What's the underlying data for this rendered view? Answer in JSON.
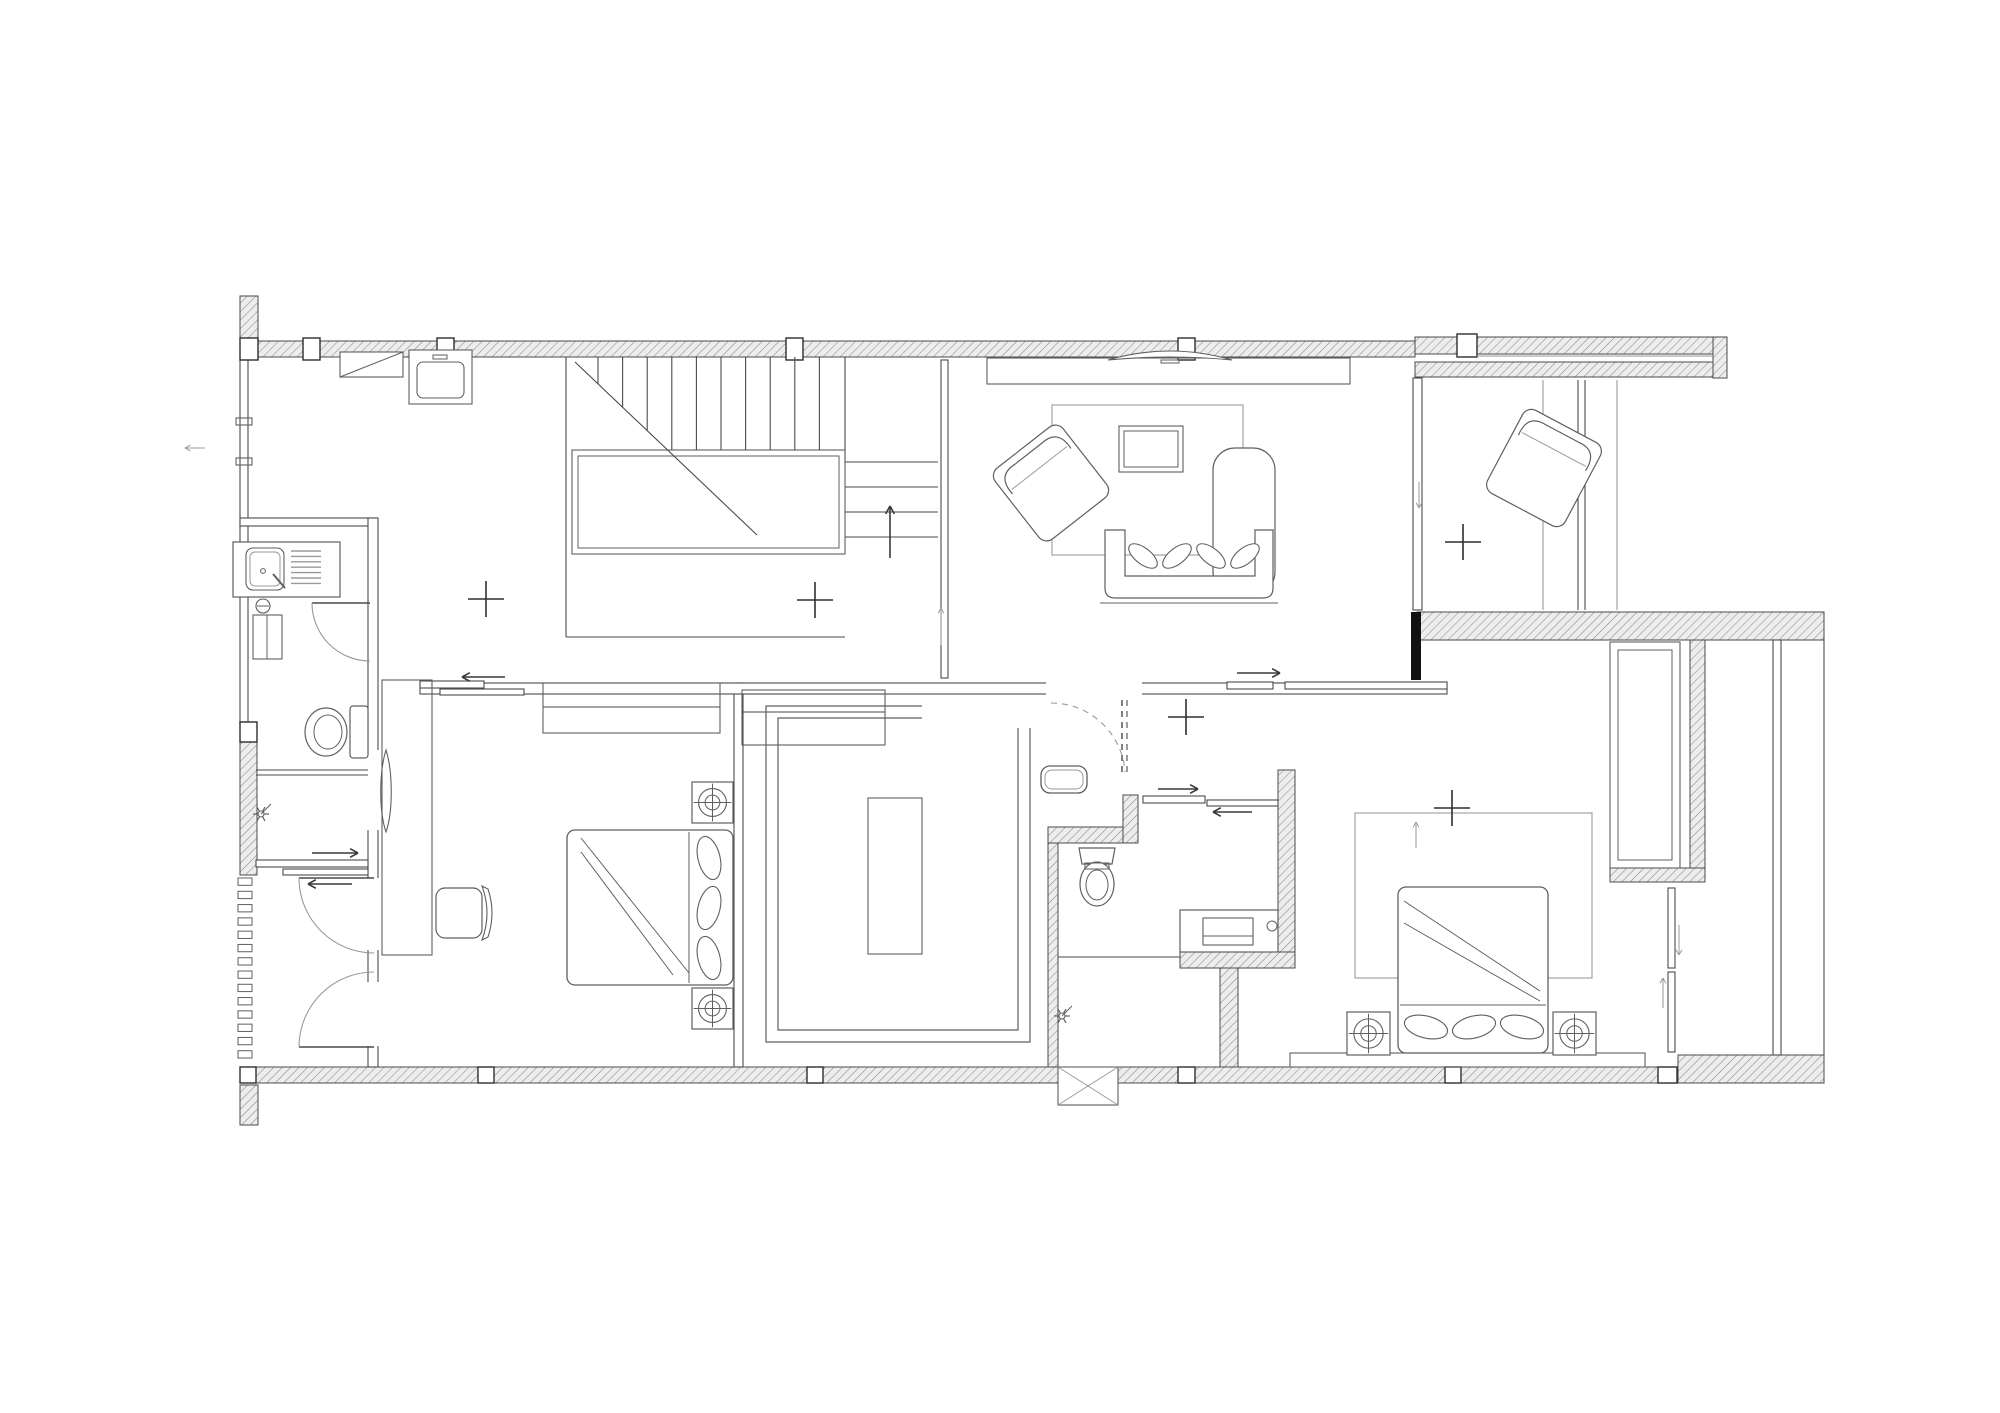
{
  "meta": {
    "canvas": {
      "w": 2000,
      "h": 1413
    }
  },
  "colors": {
    "bg": "#ffffff",
    "wall_stroke": "#4a4a4a",
    "furniture_stroke": "#5f5f5f",
    "light_stroke": "#9a9a9a",
    "hatch_fill": "#ededed",
    "hatch_line": "#8c8c8c",
    "solid_wall": "#111111",
    "column_fill": "#ffffff"
  },
  "plan": {
    "hatched_walls": [
      {
        "n": "top-wall-left",
        "x": 240,
        "y": 341,
        "w": 1175,
        "h": 16
      },
      {
        "n": "top-wall-right-outer",
        "x": 1415,
        "y": 337,
        "w": 312,
        "h": 17
      },
      {
        "n": "top-wall-right-inner",
        "x": 1415,
        "y": 362,
        "w": 298,
        "h": 15
      },
      {
        "n": "top-right-end-cap",
        "x": 1713,
        "y": 337,
        "w": 14,
        "h": 41
      },
      {
        "n": "left-wall-stub-top",
        "x": 240,
        "y": 296,
        "w": 18,
        "h": 45
      },
      {
        "n": "left-wall-mid",
        "x": 240,
        "y": 742,
        "w": 17,
        "h": 133
      },
      {
        "n": "left-wall-stub-bottom",
        "x": 240,
        "y": 1085,
        "w": 18,
        "h": 40
      },
      {
        "n": "bottom-wall-main",
        "x": 256,
        "y": 1067,
        "w": 1404,
        "h": 16
      },
      {
        "n": "bottom-wall-right",
        "x": 1678,
        "y": 1055,
        "w": 146,
        "h": 28
      },
      {
        "n": "suite-top-wall",
        "x": 1417,
        "y": 612,
        "w": 407,
        "h": 28
      },
      {
        "n": "nook-right-wall",
        "x": 1690,
        "y": 640,
        "w": 15,
        "h": 235
      },
      {
        "n": "nook-bottom-cap",
        "x": 1610,
        "y": 868,
        "w": 95,
        "h": 14
      },
      {
        "n": "bath2-right-wall",
        "x": 1278,
        "y": 770,
        "w": 17,
        "h": 198
      },
      {
        "n": "bath2-under-vanity-wall",
        "x": 1180,
        "y": 952,
        "w": 115,
        "h": 16
      },
      {
        "n": "bath2-left-wall",
        "x": 1048,
        "y": 843,
        "w": 10,
        "h": 224
      },
      {
        "n": "bath2-under-counter-wall",
        "x": 1048,
        "y": 827,
        "w": 90,
        "h": 16
      },
      {
        "n": "bath2-door-jamb",
        "x": 1123,
        "y": 795,
        "w": 15,
        "h": 48
      },
      {
        "n": "corridor-wall-bar",
        "x": 1220,
        "y": 968,
        "w": 18,
        "h": 99
      },
      {
        "n": "bed1-wall-seg-a",
        "x": 368,
        "y": 930,
        "w": 10,
        "h": 48
      },
      {
        "n": "bed1-wall-seg-b",
        "x": 368,
        "y": 1048,
        "w": 10,
        "h": 19
      }
    ],
    "solid_walls": [
      {
        "n": "suite-black-wall",
        "x": 1411,
        "y": 612,
        "w": 10,
        "h": 68
      }
    ],
    "columns": [
      {
        "n": "column",
        "x": 240,
        "y": 338,
        "w": 18,
        "h": 22
      },
      {
        "n": "column",
        "x": 303,
        "y": 338,
        "w": 17,
        "h": 22
      },
      {
        "n": "column",
        "x": 437,
        "y": 338,
        "w": 17,
        "h": 22
      },
      {
        "n": "column",
        "x": 786,
        "y": 338,
        "w": 17,
        "h": 22
      },
      {
        "n": "column",
        "x": 1178,
        "y": 338,
        "w": 17,
        "h": 22
      },
      {
        "n": "column",
        "x": 1457,
        "y": 334,
        "w": 20,
        "h": 23
      },
      {
        "n": "column",
        "x": 240,
        "y": 722,
        "w": 17,
        "h": 20
      },
      {
        "n": "column",
        "x": 240,
        "y": 1067,
        "w": 16,
        "h": 16
      },
      {
        "n": "column",
        "x": 478,
        "y": 1067,
        "w": 16,
        "h": 16
      },
      {
        "n": "column",
        "x": 807,
        "y": 1067,
        "w": 16,
        "h": 16
      },
      {
        "n": "column",
        "x": 1178,
        "y": 1067,
        "w": 17,
        "h": 16
      },
      {
        "n": "column",
        "x": 1445,
        "y": 1067,
        "w": 16,
        "h": 16
      },
      {
        "n": "column",
        "x": 1658,
        "y": 1067,
        "w": 19,
        "h": 16
      }
    ],
    "gaps": [
      {
        "n": "door-gap",
        "x": 366,
        "y": 750,
        "w": 14,
        "h": 80
      },
      {
        "n": "door-gap",
        "x": 366,
        "y": 878,
        "w": 14,
        "h": 72
      },
      {
        "n": "door-gap",
        "x": 366,
        "y": 982,
        "w": 14,
        "h": 64
      },
      {
        "n": "door-gap",
        "x": 1046,
        "y": 681,
        "w": 96,
        "h": 15
      }
    ],
    "thin_walls": [
      {
        "n": "left-window-wall",
        "x": 240,
        "y": 357,
        "w": 8,
        "h": 365
      },
      {
        "n": "bath1-top-wall",
        "x": 240,
        "y": 518,
        "w": 136,
        "h": 8
      },
      {
        "n": "bath1-right-wall",
        "x": 368,
        "y": 518,
        "w": 10,
        "h": 549
      },
      {
        "n": "hall-divider-wall",
        "x": 941,
        "y": 360,
        "w": 7,
        "h": 318
      },
      {
        "n": "bed1-right-wall",
        "x": 734,
        "y": 683,
        "w": 9,
        "h": 384
      },
      {
        "n": "corridor-wall",
        "x": 420,
        "y": 683,
        "w": 1027,
        "h": 11
      },
      {
        "n": "living-right-window",
        "x": 1413,
        "y": 378,
        "w": 9,
        "h": 232
      },
      {
        "n": "slide-track",
        "x": 420,
        "y": 681,
        "w": 64,
        "h": 7
      },
      {
        "n": "slide-track",
        "x": 440,
        "y": 689,
        "w": 84,
        "h": 6
      },
      {
        "n": "slide-track",
        "x": 256,
        "y": 860,
        "w": 112,
        "h": 7
      },
      {
        "n": "slide-track",
        "x": 283,
        "y": 869,
        "w": 85,
        "h": 6
      },
      {
        "n": "slide-track",
        "x": 1227,
        "y": 682,
        "w": 46,
        "h": 7
      },
      {
        "n": "slide-track",
        "x": 1285,
        "y": 682,
        "w": 162,
        "h": 7
      },
      {
        "n": "slide-track",
        "x": 1143,
        "y": 796,
        "w": 62,
        "h": 7
      },
      {
        "n": "slide-track",
        "x": 1207,
        "y": 800,
        "w": 71,
        "h": 6
      },
      {
        "n": "slide-track",
        "x": 1668,
        "y": 888,
        "w": 7,
        "h": 80
      },
      {
        "n": "slide-track",
        "x": 1668,
        "y": 972,
        "w": 7,
        "h": 80
      },
      {
        "n": "balcony-window",
        "x": 1773,
        "y": 640,
        "w": 8,
        "h": 415
      }
    ],
    "lines": [
      {
        "n": "stair-edge",
        "x1": 566,
        "y1": 357,
        "x2": 566,
        "y2": 637
      },
      {
        "n": "stair-edge",
        "x1": 566,
        "y1": 637,
        "x2": 845,
        "y2": 637
      },
      {
        "n": "stair-edge",
        "x1": 845,
        "y1": 357,
        "x2": 845,
        "y2": 462
      },
      {
        "n": "stair-step",
        "x1": 845,
        "y1": 462,
        "x2": 938,
        "y2": 462
      },
      {
        "n": "stair-step",
        "x1": 845,
        "y1": 487,
        "x2": 938,
        "y2": 487
      },
      {
        "n": "stair-step",
        "x1": 845,
        "y1": 512,
        "x2": 938,
        "y2": 512
      },
      {
        "n": "stair-step",
        "x1": 845,
        "y1": 537,
        "x2": 938,
        "y2": 537
      },
      {
        "n": "parapet-glazing",
        "x1": 1477,
        "y1": 356,
        "x2": 1713,
        "y2": 356,
        "light": true
      },
      {
        "n": "glass-panel",
        "x1": 1543,
        "y1": 380,
        "x2": 1543,
        "y2": 610,
        "light": true
      },
      {
        "n": "glass-panel",
        "x1": 1578,
        "y1": 380,
        "x2": 1578,
        "y2": 610
      },
      {
        "n": "glass-panel",
        "x1": 1585,
        "y1": 380,
        "x2": 1585,
        "y2": 610
      },
      {
        "n": "glass-panel",
        "x1": 1617,
        "y1": 380,
        "x2": 1617,
        "y2": 610,
        "light": true
      },
      {
        "n": "balcony-edge",
        "x1": 1824,
        "y1": 637,
        "x2": 1824,
        "y2": 1055
      },
      {
        "n": "shower-divider",
        "x1": 256,
        "y1": 770,
        "x2": 368,
        "y2": 770
      },
      {
        "n": "shower-divider",
        "x1": 256,
        "y1": 775,
        "x2": 368,
        "y2": 775
      },
      {
        "n": "bath2-shower-divider",
        "x1": 1058,
        "y1": 957,
        "x2": 1180,
        "y2": 957
      },
      {
        "n": "band-shelf-line",
        "x1": 543,
        "y1": 707,
        "x2": 720,
        "y2": 707
      },
      {
        "n": "band-shelf-line",
        "x1": 742,
        "y1": 712,
        "x2": 885,
        "y2": 712
      }
    ],
    "rects": [
      {
        "n": "stair-landing",
        "x": 572,
        "y": 450,
        "w": 273,
        "h": 104,
        "inset": 6
      },
      {
        "n": "closet-band-left",
        "x": 543,
        "y": 683,
        "w": 177,
        "h": 50
      },
      {
        "n": "closet-band-right",
        "x": 742,
        "y": 690,
        "w": 143,
        "h": 55
      },
      {
        "n": "closet-island",
        "x": 868,
        "y": 798,
        "w": 54,
        "h": 156
      },
      {
        "n": "living-rug",
        "x": 1052,
        "y": 405,
        "w": 191,
        "h": 150,
        "light": true
      },
      {
        "n": "coffee-table",
        "x": 1119,
        "y": 426,
        "w": 64,
        "h": 46,
        "inset": 5
      },
      {
        "n": "tv-console",
        "x": 987,
        "y": 358,
        "w": 363,
        "h": 26
      },
      {
        "n": "desk",
        "x": 382,
        "y": 680,
        "w": 50,
        "h": 275
      },
      {
        "n": "wardrobe-nook",
        "x": 1610,
        "y": 642,
        "w": 70,
        "h": 226,
        "inset": 8
      },
      {
        "n": "bedroom2-rug",
        "x": 1355,
        "y": 813,
        "w": 237,
        "h": 165,
        "light": true
      },
      {
        "n": "bed-bench",
        "x": 1290,
        "y": 1053,
        "w": 355,
        "h": 14
      },
      {
        "n": "window-sill",
        "x": 236,
        "y": 418,
        "w": 16,
        "h": 7
      },
      {
        "n": "window-sill",
        "x": 236,
        "y": 458,
        "w": 16,
        "h": 7
      }
    ],
    "stripe_groups": [
      {
        "n": "louver-vent",
        "x": 238,
        "y": 878,
        "w": 14,
        "h": 186,
        "count": 14,
        "dir": "h"
      }
    ],
    "stairs": {
      "n": "stair-treads",
      "x0": 598,
      "count": 10,
      "dx": 24.6,
      "y1": 357,
      "y2": 450,
      "diag": [
        575,
        362,
        757,
        535
      ]
    },
    "closet_paths": [
      {
        "n": "walkin-closet-outline",
        "d": "M 922,706 L 766,706 L 766,1042 L 1030,1042 L 1030,728"
      },
      {
        "n": "walkin-closet-outline",
        "d": "M 922,718 L 778,718 L 778,1030 L 1018,1030 L 1018,728"
      }
    ],
    "door_swings": [
      {
        "n": "bath1-door-swing",
        "leaf": [
          312,
          603,
          370,
          603
        ],
        "arc": "M 312,603 A 58 58 0 0 0 370,661"
      },
      {
        "n": "vestibule-door-swing",
        "leaf": [
          299,
          878,
          374,
          878
        ],
        "arc": "M 299,878 A 75 75 0 0 0 374,953"
      },
      {
        "n": "vestibule-door-swing-2",
        "leaf": [
          299,
          1047,
          374,
          1047
        ],
        "arc": "M 299,1047 A 75 75 0 0 1 374,972"
      },
      {
        "n": "bath2-door-swing",
        "leaf": [
          1122,
          700,
          1122,
          772
        ],
        "leaf2": [
          1127,
          700,
          1127,
          772
        ],
        "arc": "M 1051,703 A 74 74 0 0 1 1125,772",
        "dashed": true
      }
    ],
    "mirror_lens": {
      "n": "mirror",
      "d": "M 386,750 C 379,772 379,812 386,832 C 393,812 393,772 386,750 Z"
    },
    "fixtures": [
      {
        "t": "sinkcounter",
        "n": "kitchen-sink-counter",
        "x": 233,
        "y": 542
      },
      {
        "t": "heater",
        "n": "water-heater",
        "x": 253,
        "y": 598
      },
      {
        "t": "toilet",
        "n": "toilet",
        "x": 326,
        "y": 732,
        "dir": "w"
      },
      {
        "t": "showerhead",
        "n": "shower-head",
        "x": 261,
        "y": 814
      },
      {
        "t": "toilet",
        "n": "toilet",
        "x": 1097,
        "y": 884,
        "dir": "s"
      },
      {
        "t": "basin",
        "n": "countertop-basin",
        "x": 1041,
        "y": 766
      },
      {
        "t": "vanity",
        "n": "vanity-cabinet",
        "x": 1180,
        "y": 910
      },
      {
        "t": "showerhead",
        "n": "shower-head",
        "x": 1062,
        "y": 1016
      },
      {
        "t": "tv",
        "n": "television",
        "x": 1170,
        "y": 352
      },
      {
        "t": "sofa",
        "n": "l-shaped-sofa",
        "x": 1105,
        "y": 448
      },
      {
        "t": "armchair",
        "n": "armchair",
        "x": 1051,
        "y": 483,
        "rot": -38,
        "w": 86,
        "h": 90
      },
      {
        "t": "armchair",
        "n": "armchair",
        "x": 1544,
        "y": 468,
        "rot": 28,
        "w": 88,
        "h": 94
      },
      {
        "t": "chair",
        "n": "desk-chair",
        "x": 462,
        "y": 913
      },
      {
        "t": "bed",
        "n": "bed-double",
        "x": 567,
        "y": 830,
        "w": 166,
        "h": 155,
        "head": "right"
      },
      {
        "t": "bed",
        "n": "bed-double",
        "x": 1398,
        "y": 887,
        "w": 150,
        "h": 166,
        "head": "bottom"
      },
      {
        "t": "spot",
        "n": "ceiling-spotlight",
        "x": 692,
        "y": 782,
        "s": 41
      },
      {
        "t": "spot",
        "n": "ceiling-spotlight",
        "x": 692,
        "y": 988,
        "s": 41
      },
      {
        "t": "spot",
        "n": "ceiling-spotlight",
        "x": 1347,
        "y": 1012,
        "s": 43
      },
      {
        "t": "spot",
        "n": "ceiling-spotlight",
        "x": 1553,
        "y": 1012,
        "s": 43
      },
      {
        "t": "acx",
        "n": "ac-outdoor-unit",
        "x": 1058,
        "y": 1067,
        "w": 60,
        "h": 38
      },
      {
        "t": "appliance",
        "n": "cooktop-appliance",
        "x": 409,
        "y": 350
      },
      {
        "t": "diagrect",
        "n": "vent-cabinet",
        "x": 340,
        "y": 352,
        "w": 63,
        "h": 25
      }
    ],
    "arrows": [
      {
        "n": "stair-up-arrow",
        "x1": 890,
        "y1": 558,
        "x2": 890,
        "y2": 506
      },
      {
        "n": "slide-arrow",
        "x1": 941,
        "y1": 645,
        "x2": 941,
        "y2": 608,
        "light": true
      },
      {
        "n": "slide-arrow",
        "x1": 505,
        "y1": 677,
        "x2": 462,
        "y2": 677
      },
      {
        "n": "slide-arrow",
        "x1": 312,
        "y1": 853,
        "x2": 358,
        "y2": 853
      },
      {
        "n": "slide-arrow",
        "x1": 352,
        "y1": 884,
        "x2": 308,
        "y2": 884
      },
      {
        "n": "slide-arrow",
        "x1": 1237,
        "y1": 673,
        "x2": 1280,
        "y2": 673
      },
      {
        "n": "slide-arrow",
        "x1": 1158,
        "y1": 789,
        "x2": 1198,
        "y2": 789
      },
      {
        "n": "slide-arrow",
        "x1": 1252,
        "y1": 812,
        "x2": 1213,
        "y2": 812
      },
      {
        "n": "window-arrow",
        "x1": 1419,
        "y1": 482,
        "x2": 1419,
        "y2": 508,
        "light": true
      },
      {
        "n": "window-arrow",
        "x1": 1416,
        "y1": 848,
        "x2": 1416,
        "y2": 822,
        "light": true
      },
      {
        "n": "window-arrow",
        "x1": 1679,
        "y1": 925,
        "x2": 1679,
        "y2": 955,
        "light": true
      },
      {
        "n": "window-arrow",
        "x1": 1663,
        "y1": 1008,
        "x2": 1663,
        "y2": 978,
        "light": true
      },
      {
        "n": "window-arrow",
        "x1": 205,
        "y1": 448,
        "x2": 185,
        "y2": 448,
        "light": true
      }
    ],
    "crosses": [
      {
        "n": "survey-cross",
        "x": 486,
        "y": 599
      },
      {
        "n": "survey-cross",
        "x": 815,
        "y": 600
      },
      {
        "n": "survey-cross",
        "x": 1463,
        "y": 542
      },
      {
        "n": "survey-cross",
        "x": 1186,
        "y": 717
      },
      {
        "n": "survey-cross",
        "x": 1452,
        "y": 808
      }
    ]
  }
}
